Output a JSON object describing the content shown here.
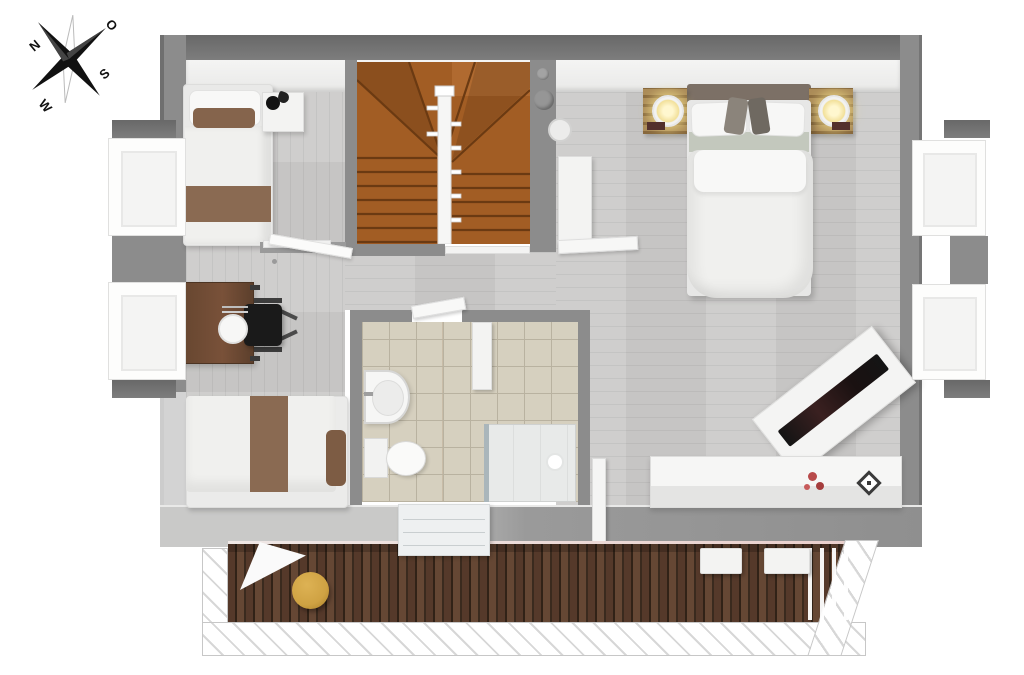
{
  "compass": {
    "n": "N",
    "o": "O",
    "s": "S",
    "w": "W"
  },
  "palette": {
    "wall": "#8c8c8c",
    "wallDark": "#686868",
    "floor": "#cccbca",
    "tile": "#d6d0bf",
    "tileLine": "#b9b2a0",
    "stairs": "#a25d24",
    "stairsDark": "#6b3a12",
    "deck": "#5a3d2c",
    "deckDark": "#312217",
    "railHatch": "#d7d7d7",
    "bedWhite": "#f0f0ee",
    "accentBrown": "#8a6a52",
    "headboard": "#7c7066",
    "deskWood": "#64452f",
    "nightstandWood": "#ab8b58",
    "lampGlow": "#f2e09a",
    "chairBlack": "#1a1a1a",
    "pouf": "#cfa243",
    "flower": "#b84a4a",
    "glass": "#aab6bb"
  }
}
